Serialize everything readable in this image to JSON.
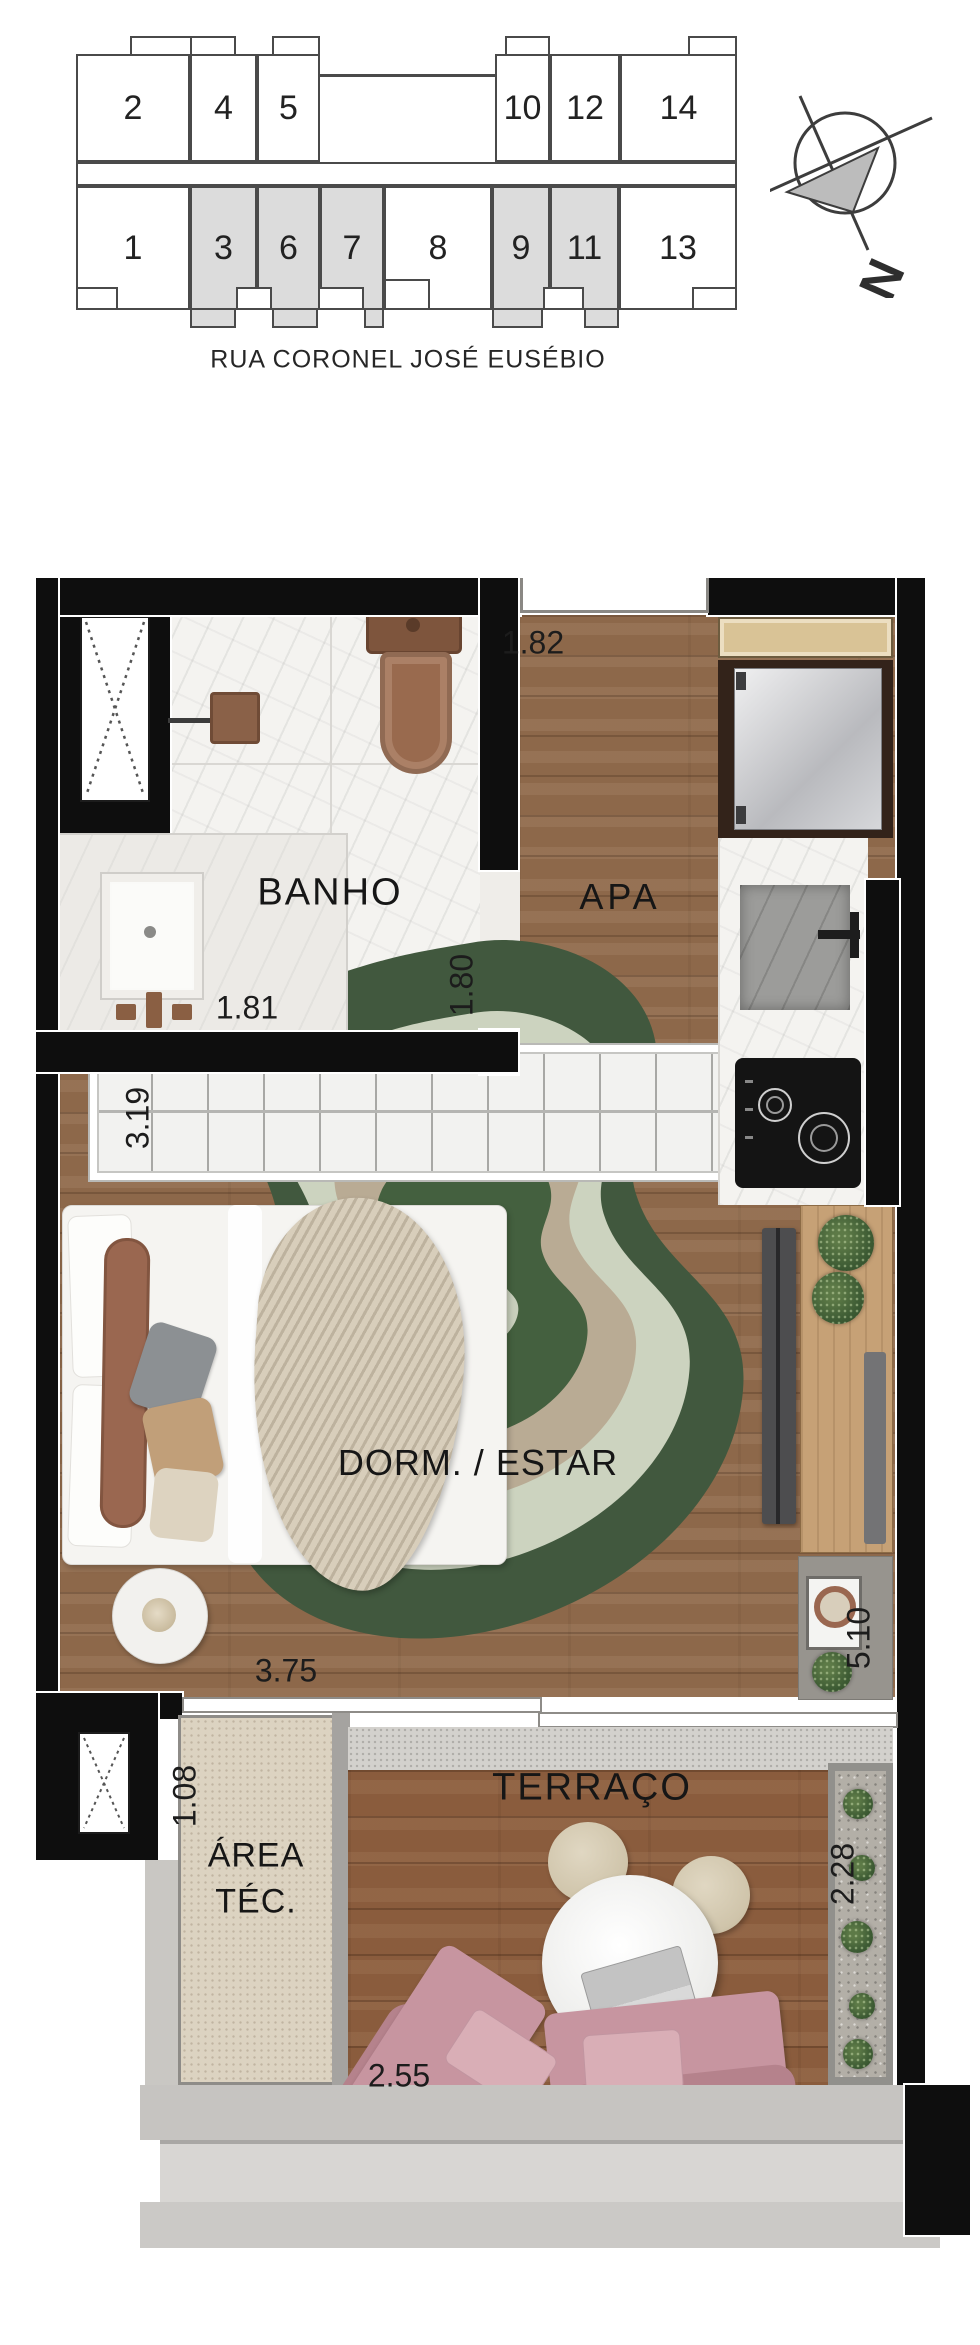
{
  "site_plan": {
    "street": "RUA CORONEL JOSÉ EUSÉBIO",
    "compass_label": "N",
    "top_units": [
      {
        "label": "2",
        "highlighted": false
      },
      {
        "label": "4",
        "highlighted": false
      },
      {
        "label": "5",
        "highlighted": false
      },
      {
        "label": "10",
        "highlighted": false
      },
      {
        "label": "12",
        "highlighted": false
      },
      {
        "label": "14",
        "highlighted": false
      }
    ],
    "bottom_units": [
      {
        "label": "1",
        "highlighted": false
      },
      {
        "label": "3",
        "highlighted": true
      },
      {
        "label": "6",
        "highlighted": true
      },
      {
        "label": "7",
        "highlighted": true
      },
      {
        "label": "8",
        "highlighted": false
      },
      {
        "label": "9",
        "highlighted": true
      },
      {
        "label": "11",
        "highlighted": true
      },
      {
        "label": "13",
        "highlighted": false
      }
    ]
  },
  "floor_plan": {
    "rooms": {
      "bath": "BANHO",
      "entry": "APA",
      "living": "DORM. / ESTAR",
      "tech_line1": "ÁREA",
      "tech_line2": "TÉC.",
      "terrace": "TERRAÇO"
    },
    "dimensions": {
      "entry_width": "1.82",
      "bath_width": "1.81",
      "bath_depth": "1.80",
      "closet_width": "3.19",
      "room_width": "3.75",
      "room_depth": "5.10",
      "tech_width": "1.08",
      "planter_depth": "2.28",
      "terrace_width": "2.55"
    }
  },
  "colors": {
    "wall_black": "#0e0e0e",
    "wood_floor": "#8d684a",
    "terrace_deck": "#8a5c3d",
    "rug_dark_green": "#41583e",
    "rug_sage": "#ccd3bf",
    "rug_beige": "#b9ab94",
    "sofa_pink": "#c795a0",
    "fixture_brown": "#8f6349",
    "highlight_unit_gray": "#dcdcdc"
  }
}
